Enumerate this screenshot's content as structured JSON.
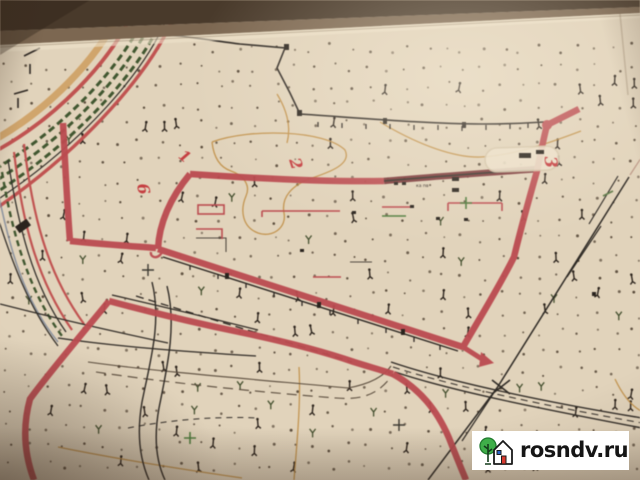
{
  "map": {
    "plot_labels": {
      "p1": "1",
      "p2": "2",
      "p3": "3",
      "p6": "6"
    },
    "annotation": "ка пв",
    "colors": {
      "boundary_red": "#bf4a4f",
      "boundary_dark_red": "#7a3336",
      "contour_orange": "#c18e42",
      "road_dark": "#2e2a25",
      "vegetation_green": "#40572f",
      "paper": "#e2d3ba",
      "label_red": "#c93d40"
    }
  },
  "watermark": {
    "site": "rosndv.ru",
    "logo": "tree-and-house",
    "background": "#ffffff",
    "text_color": "#151515"
  }
}
